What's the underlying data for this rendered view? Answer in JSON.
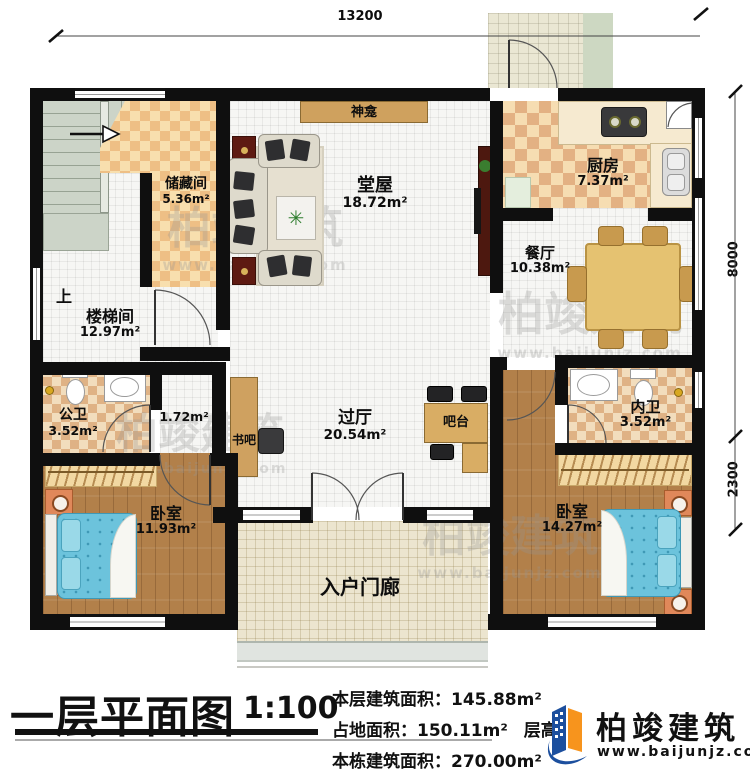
{
  "dimensions": {
    "top": "13200",
    "right_upper": "8000",
    "right_lower": "2300"
  },
  "rooms": {
    "chucangjian": {
      "name": "储藏间",
      "area": "5.36m²"
    },
    "shenkan": {
      "name": "神龛"
    },
    "tangwu": {
      "name": "堂屋",
      "area": "18.72m²"
    },
    "chufang": {
      "name": "厨房",
      "area": "7.37m²"
    },
    "canting": {
      "name": "餐厅",
      "area": "10.38m²"
    },
    "loutijian": {
      "name": "楼梯间",
      "area": "12.97m²"
    },
    "shang": {
      "label": "上"
    },
    "gongwei": {
      "name": "公卫",
      "area": "3.52m²"
    },
    "closet": {
      "area": "1.72m²"
    },
    "shuba": {
      "name": "书吧"
    },
    "guoting": {
      "name": "过厅",
      "area": "20.54m²"
    },
    "batai": {
      "name": "吧台"
    },
    "neiwei": {
      "name": "内卫",
      "area": "3.52m²"
    },
    "woshi_left": {
      "name": "卧室",
      "area": "11.93m²"
    },
    "woshi_right": {
      "name": "卧室",
      "area": "14.27m²"
    },
    "ruhumenlang": {
      "name": "入户门廊"
    }
  },
  "footer": {
    "title": "一层平面图",
    "scale": "1:100",
    "line1_label": "本层建筑面积：",
    "line1_value": "145.88m²",
    "line2_label": "占地面积：",
    "line2_value": "150.11m²",
    "line2_label2": "层高：",
    "line3_label": "本栋建筑面积：",
    "line3_value": "270.00m²"
  },
  "brand": {
    "name": "柏竣建筑",
    "url": "www.baijunjz.com"
  },
  "watermark": {
    "text": "柏竣建筑",
    "url": "www.baijunjz.com"
  },
  "colors": {
    "brand_blue": "#1c4f9e",
    "brand_orange": "#f7941d",
    "wall": "#0f0f0f"
  }
}
